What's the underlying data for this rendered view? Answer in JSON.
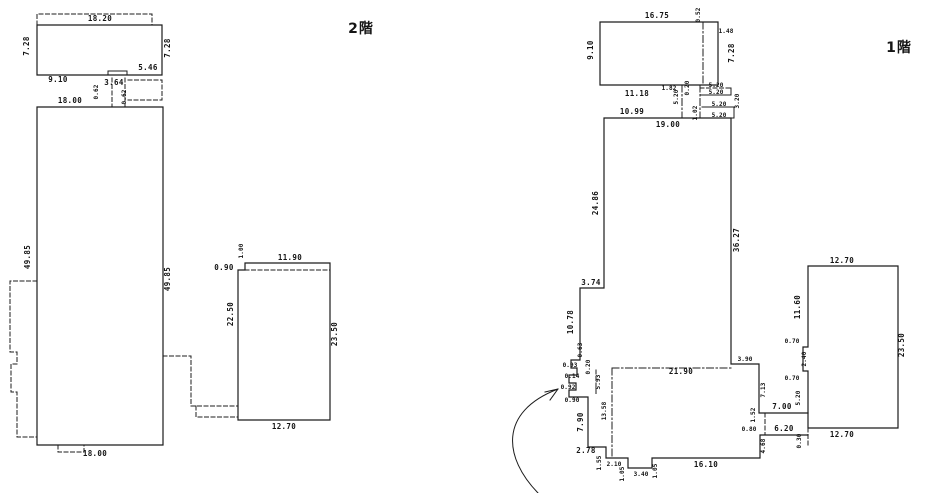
{
  "drawing": {
    "bg_color": "#ffffff",
    "line_color": "#1c1c1c"
  },
  "floor2": {
    "title": "2階",
    "dims": {
      "top_width": "18.20",
      "top_left_height": "7.28",
      "top_right_height": "7.28",
      "top_bottom_left": "9.10",
      "top_bottom_right": "5.46",
      "connector_width": "3.64",
      "connector_left": "0.62",
      "connector_right": "0.62",
      "main_top_width": "18.00",
      "main_left_height": "49.85",
      "main_right_height": "49.85",
      "main_bottom_width": "18.00",
      "annex_notch": "1.00",
      "annex_top_width": "11.90",
      "annex_offset": "0.90",
      "annex_left_height": "22.50",
      "annex_right_height": "23.50",
      "annex_bottom_width": "12.70"
    }
  },
  "floor1": {
    "title": "1階",
    "dims": {
      "top_width": "16.75",
      "top_left_height": "9.10",
      "notch_height": "0.52",
      "notch_width": "1.48",
      "top_right_height": "7.28",
      "top_bottom_width": "11.18",
      "gap_width": "1.82",
      "gap_height": "0.20",
      "stair_w1": "5.20",
      "stair_w2": "5.20",
      "stair_left_v": "5.20",
      "stair_right_v": "3.20",
      "stair_w3": "5.20",
      "stair_w4": "5.20",
      "stair_small_v": "1.02",
      "main_top_seg": "10.99",
      "main_top_width": "19.00",
      "main_left_height": "24.86",
      "main_right_height": "36.27",
      "step_width": "3.74",
      "left_lower_height": "10.78",
      "jog_a": "0.63",
      "jog_b": "0.93",
      "jog_c": "0.14",
      "jog_d": "0.92",
      "jog_e": "0.90",
      "jog_f": "0.20",
      "inner_left_v": "5.93",
      "wing_top_width": "21.90",
      "wing_right_notch": "3.90",
      "wing_right_v1": "7.13",
      "left_bottom_height": "7.90",
      "inner_height": "13.58",
      "bottom_step_width": "2.78",
      "bottom_step_height": "1.55",
      "bottom_seg1": "2.10",
      "bottom_notch_left": "1.05",
      "bottom_notch_width": "3.40",
      "bottom_notch_right": "1.05",
      "bottom_width": "16.10",
      "link_width": "7.00",
      "link_v": "1.52",
      "link_small": "0.80",
      "link_width2": "6.20",
      "wing_right_v2": "4.68",
      "annex_top_width": "12.70",
      "annex_left_v1": "11.60",
      "annex_notch_a": "0.70",
      "annex_notch_v": "2.40",
      "annex_notch_b": "0.70",
      "annex_left_v2": "5.20",
      "annex_right_height": "23.50",
      "annex_bottom_width": "12.70",
      "annex_below": "0.30"
    }
  }
}
